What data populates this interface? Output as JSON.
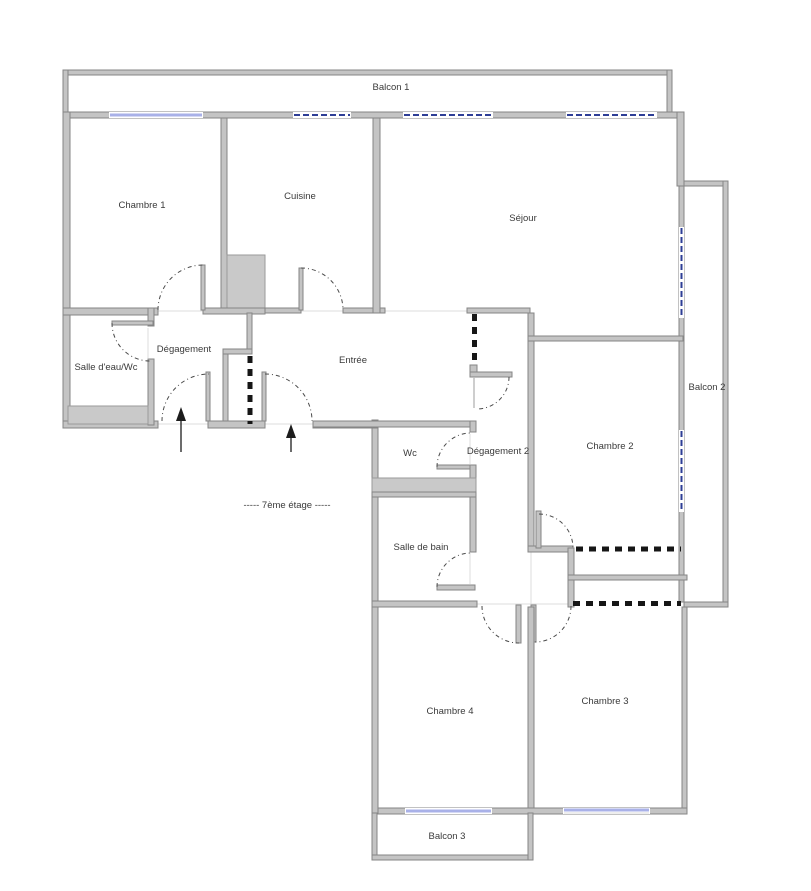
{
  "floor_plan": {
    "title": "Plan d'appartement",
    "floor_label": "-----  7ème étage  -----",
    "rooms": {
      "balcon1": "Balcon 1",
      "chambre1": "Chambre 1",
      "cuisine": "Cuisine",
      "sejour": "Séjour",
      "salle_eau_wc": "Salle d'eau/Wc",
      "degagement": "Dégagement",
      "entree": "Entrée",
      "wc": "Wc",
      "degagement2": "Dégagement 2",
      "chambre2": "Chambre 2",
      "balcon2": "Balcon 2",
      "salle_de_bain": "Salle de bain",
      "chambre4": "Chambre 4",
      "chambre3": "Chambre 3",
      "balcon3": "Balcon 3"
    },
    "colors": {
      "wall_fill": "#c4c4c4",
      "wall_stroke": "#858585",
      "window_dark_blue": "#2e3e96",
      "window_light_blue": "#a9b1e8",
      "fixture_gray": "#c9c9c9",
      "opening_dash": "#161616",
      "label_text": "#3a3a3a"
    },
    "annotations": {
      "entrance_arrows": 2
    }
  }
}
